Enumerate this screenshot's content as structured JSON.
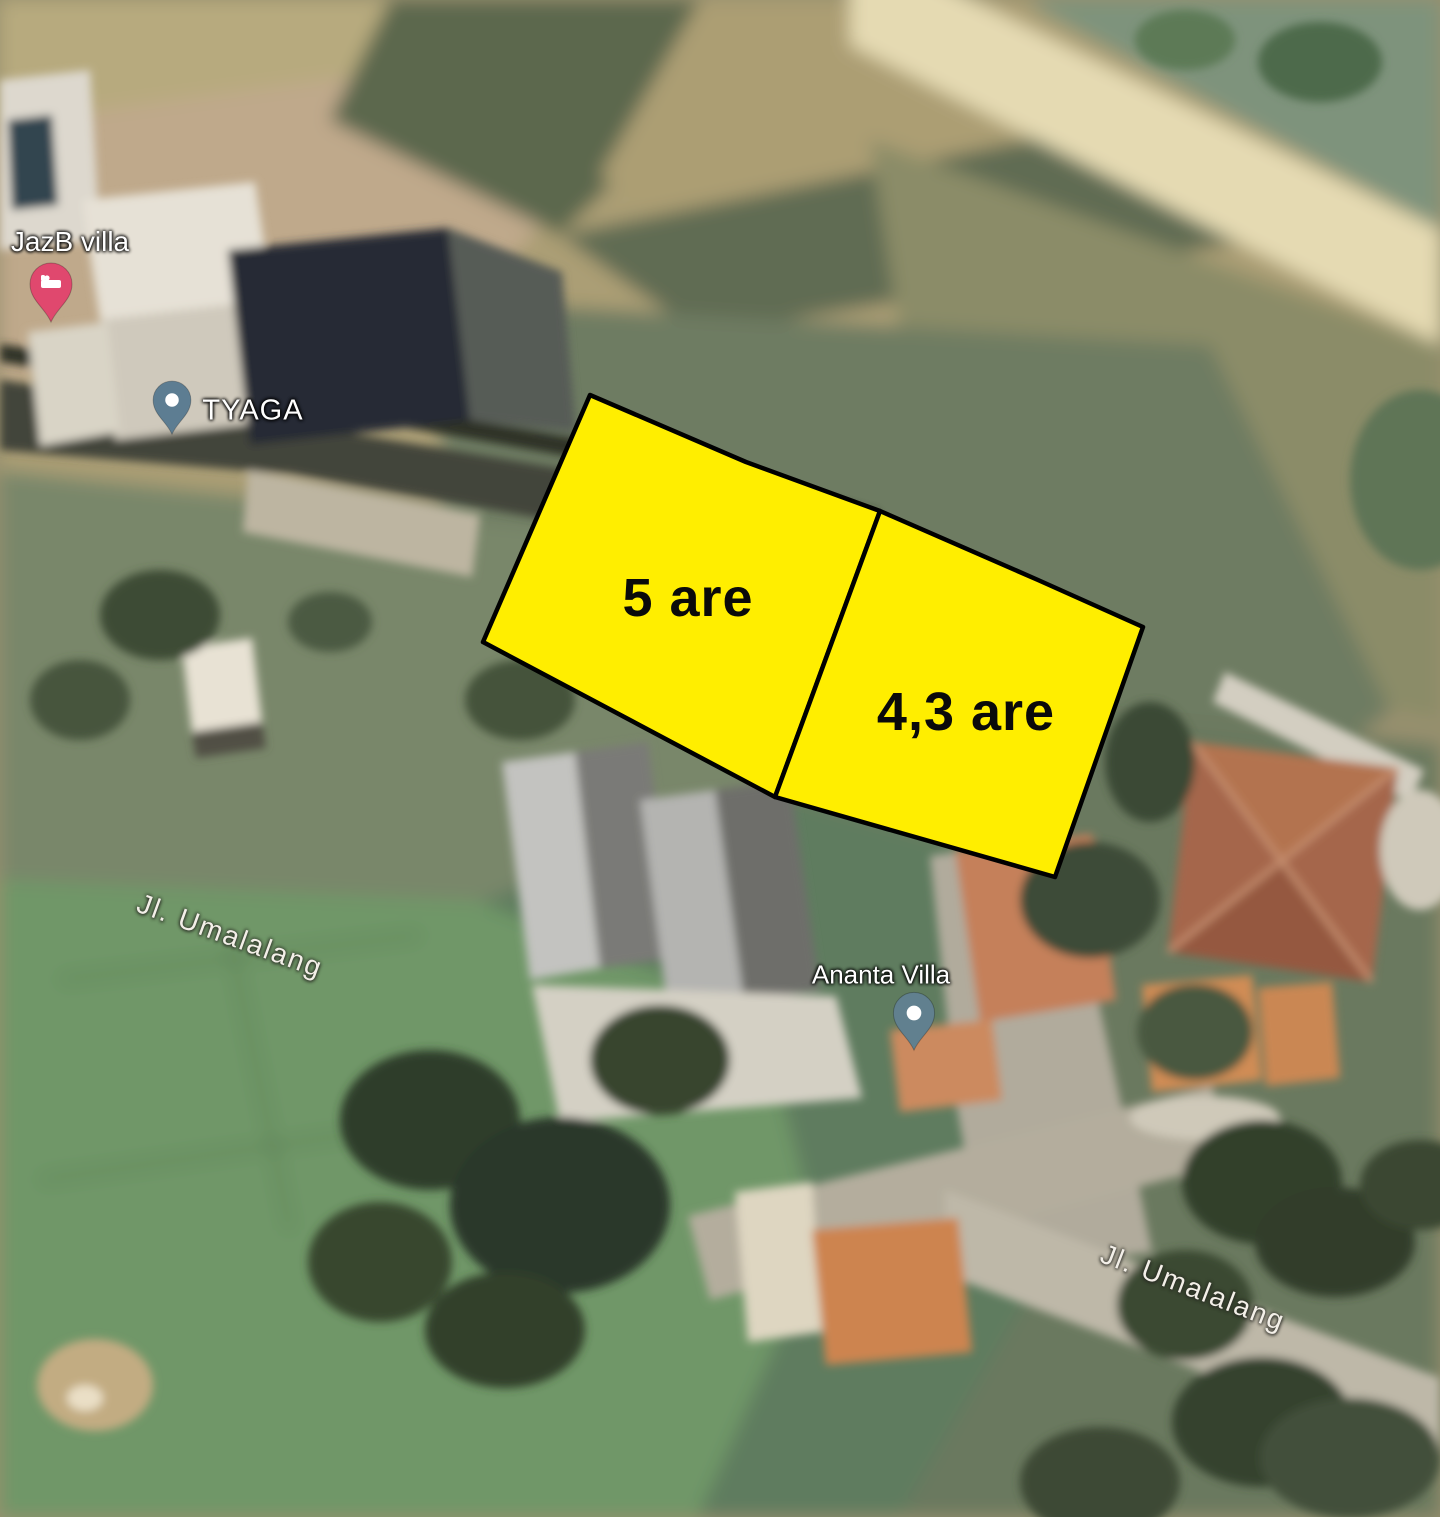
{
  "map": {
    "type": "satellite-imagery-with-land-plot-overlay",
    "plots": [
      {
        "label": "5 are",
        "area": "5",
        "unit": "are",
        "fill": "#ffee00",
        "stroke": "#000000",
        "points": "590,395 746,462 880,511 775,797 483,642"
      },
      {
        "label": "4,3 are",
        "area": "4,3",
        "unit": "are",
        "fill": "#ffee00",
        "stroke": "#000000",
        "points": "880,511 1038,580 1143,627 1055,877 775,797"
      }
    ],
    "poi": [
      {
        "name": "JazB villa",
        "pin_icon": "bed-pin",
        "pin_color": "#e0486e"
      },
      {
        "name": "TYAGA",
        "pin_icon": "dot-pin",
        "pin_color": "#5d7d92"
      },
      {
        "name": "Ananta Villa",
        "pin_icon": "dot-pin",
        "pin_color": "#61808f"
      }
    ],
    "roads": [
      {
        "name": "Jl. Umalalang"
      },
      {
        "name": "Jl. Umalalang"
      }
    ],
    "label_color": "#ffffff"
  }
}
